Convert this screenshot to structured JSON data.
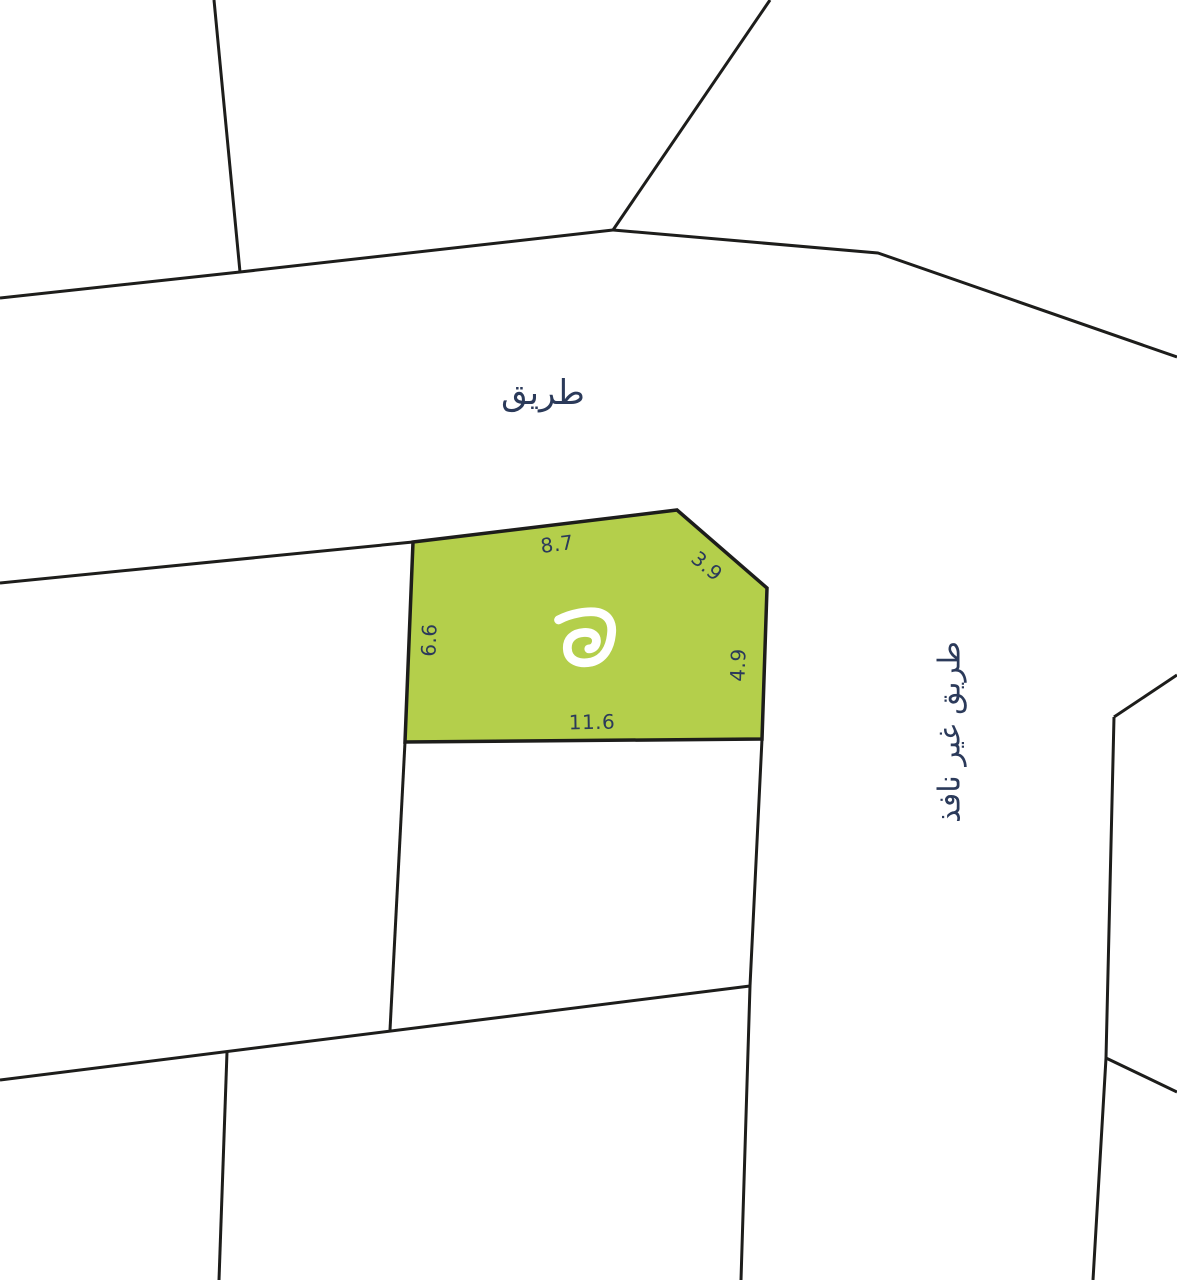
{
  "map": {
    "type": "cadastral-plot-map",
    "colors": {
      "background": "#ffffff",
      "boundary": "#1d1d1b",
      "plot_fill": "#b4cf4b",
      "plot_outline": "#1d1d1b",
      "label_text": "#2b3a5a",
      "logo": "#ffffff"
    },
    "road_labels": {
      "road": "طريق",
      "dead_end_road": "طريق غير نافذ"
    },
    "plot": {
      "logo_icon": "brand-spiral-mark",
      "dimensions": {
        "top": "8.7",
        "bevel": "3.9",
        "left": "6.6",
        "right": "4.9",
        "bottom": "11.6"
      }
    }
  }
}
